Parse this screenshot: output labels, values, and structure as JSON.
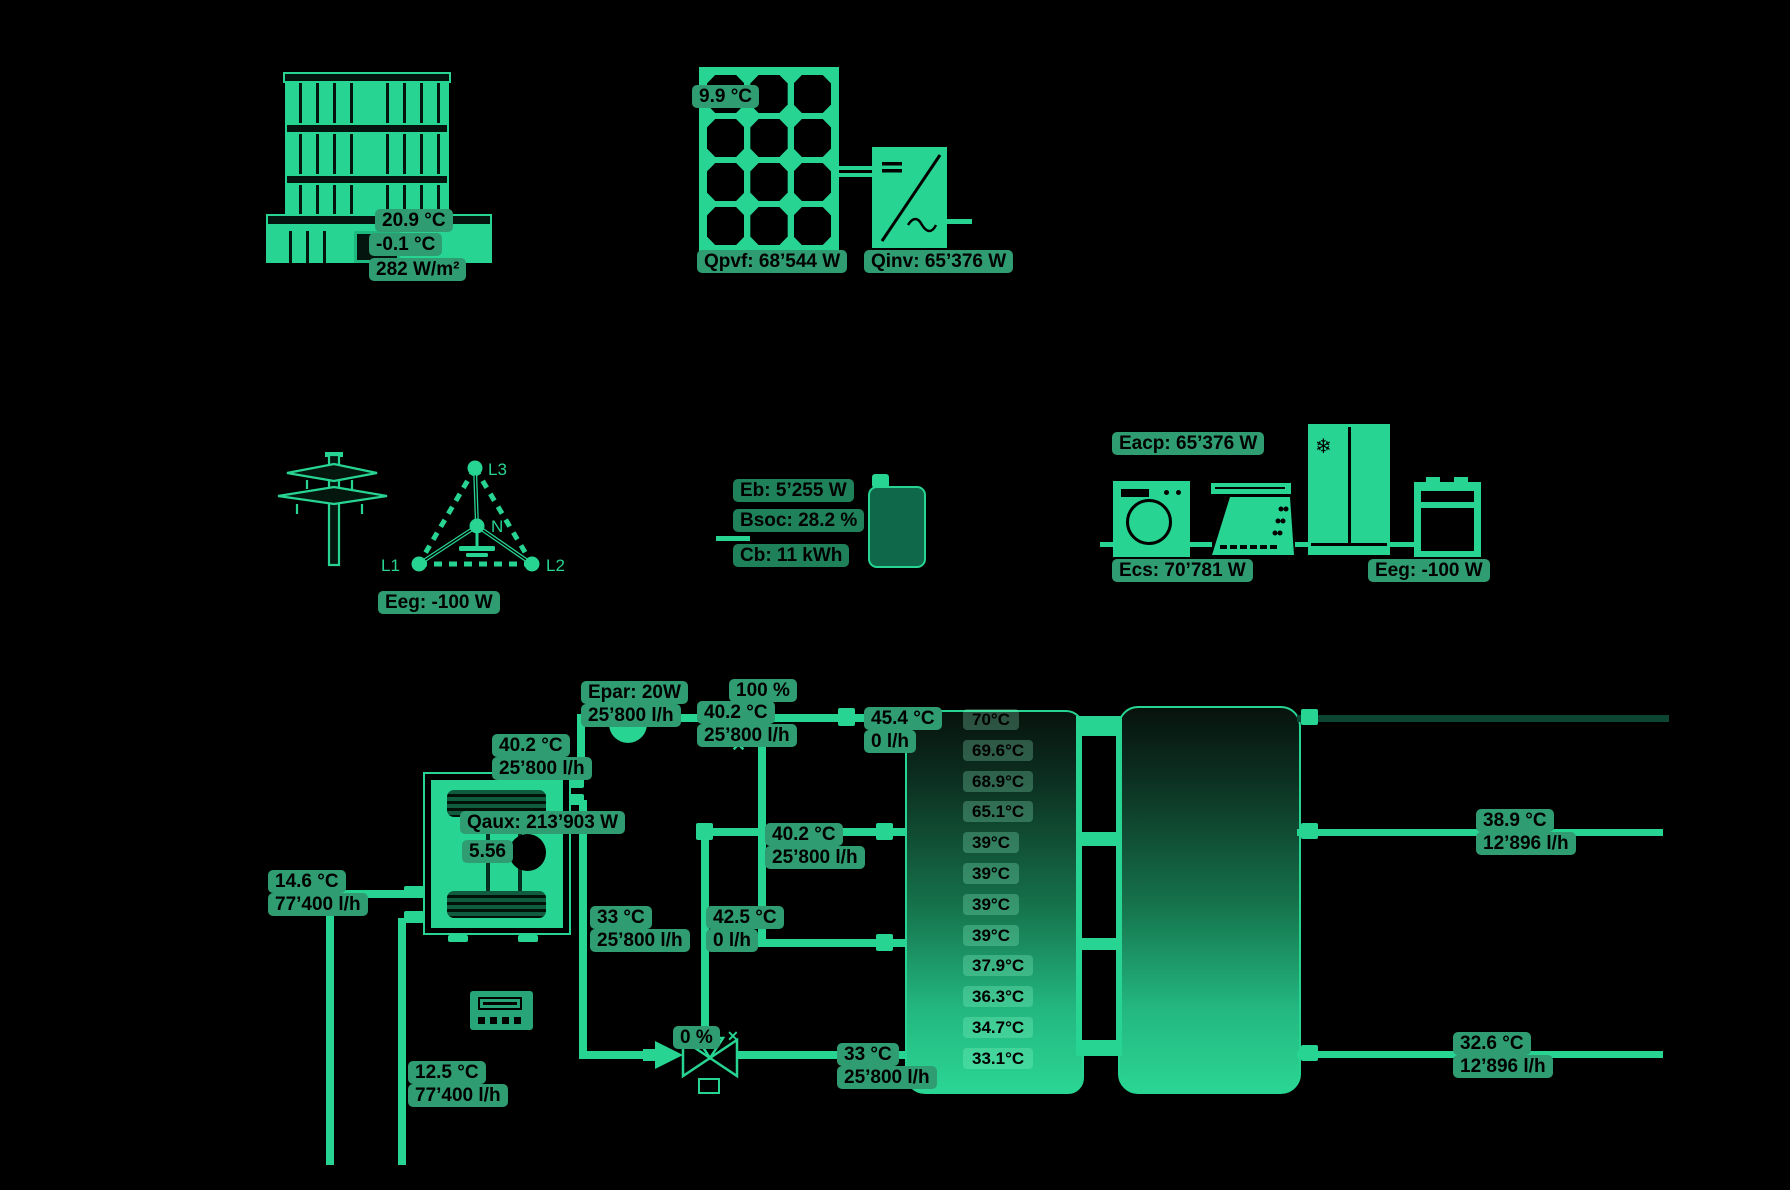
{
  "colors": {
    "accent": "#27d492",
    "chip_bg": "#2f9c72",
    "chip_dark_bg": "#1e815a",
    "pipe_dark": "#0c4531",
    "background": "#000000"
  },
  "icons": {
    "valve_x": "✕",
    "snowflake": "❄"
  },
  "grid_phases": {
    "l1": "L1",
    "l2": "L2",
    "l3": "L3",
    "n": "N"
  },
  "chips": [
    {
      "name": "building-ambient-temp",
      "lines": [
        "20.9 °C"
      ]
    },
    {
      "name": "building-outdoor-temp",
      "lines": [
        "-0.1 °C"
      ]
    },
    {
      "name": "building-irradiance",
      "lines": [
        "282 W/m²"
      ]
    },
    {
      "name": "pv-temp",
      "lines": [
        "9.9 °C"
      ]
    },
    {
      "name": "qpvf",
      "lines": [
        "Qpvf: 68’544 W"
      ]
    },
    {
      "name": "qinv",
      "lines": [
        "Qinv: 65’376 W"
      ]
    },
    {
      "name": "grid-eeg",
      "lines": [
        "Eeg: -100 W"
      ]
    },
    {
      "name": "battery-eb",
      "lines": [
        "Eb: 5’255 W"
      ],
      "variant": "dark"
    },
    {
      "name": "battery-bsoc",
      "lines": [
        "Bsoc: 28.2 %"
      ],
      "variant": "dark"
    },
    {
      "name": "battery-cb",
      "lines": [
        "Cb: 11 kWh"
      ],
      "variant": "dark"
    },
    {
      "name": "appliances-eacp",
      "lines": [
        "Eacp: 65’376 W"
      ]
    },
    {
      "name": "appliances-ecs",
      "lines": [
        "Ecs: 70’781 W"
      ]
    },
    {
      "name": "appliances-eeg",
      "lines": [
        "Eeg: -100 W"
      ]
    },
    {
      "name": "pump-epar",
      "lines": [
        "Epar: 20W",
        "25’800 l/h"
      ]
    },
    {
      "name": "valve-open-pct",
      "lines": [
        "100 %"
      ]
    },
    {
      "name": "supply-line",
      "lines": [
        "40.2 °C",
        "25’800 l/h"
      ]
    },
    {
      "name": "tank-top-port",
      "lines": [
        "45.4 °C",
        "0 l/h"
      ]
    },
    {
      "name": "hp-outlet",
      "lines": [
        "40.2 °C",
        "25’800 l/h"
      ]
    },
    {
      "name": "hp-qaux",
      "lines": [
        "Qaux: 213’903 W"
      ]
    },
    {
      "name": "hp-cop",
      "lines": [
        "5.56"
      ]
    },
    {
      "name": "tank-mid-line",
      "lines": [
        "40.2 °C",
        "25’800 l/h"
      ]
    },
    {
      "name": "brine-in",
      "lines": [
        "14.6 °C",
        "77’400 l/h"
      ]
    },
    {
      "name": "hp-return",
      "lines": [
        "33 °C",
        "25’800 l/h"
      ]
    },
    {
      "name": "tank-upper-return",
      "lines": [
        "42.5 °C",
        "0 l/h"
      ]
    },
    {
      "name": "mix-valve-pct",
      "lines": [
        "0 %"
      ]
    },
    {
      "name": "tank-bottom-line",
      "lines": [
        "33 °C",
        "25’800 l/h"
      ]
    },
    {
      "name": "brine-out",
      "lines": [
        "12.5 °C",
        "77’400 l/h"
      ]
    },
    {
      "name": "dhw-out",
      "lines": [
        "38.9 °C",
        "12’896 l/h"
      ]
    },
    {
      "name": "dhw-return",
      "lines": [
        "32.6 °C",
        "12’896 l/h"
      ]
    }
  ],
  "tank": {
    "temps": [
      "70°C",
      "69.6°C",
      "68.9°C",
      "65.1°C",
      "39°C",
      "39°C",
      "39°C",
      "39°C",
      "37.9°C",
      "36.3°C",
      "34.7°C",
      "33.1°C"
    ]
  }
}
